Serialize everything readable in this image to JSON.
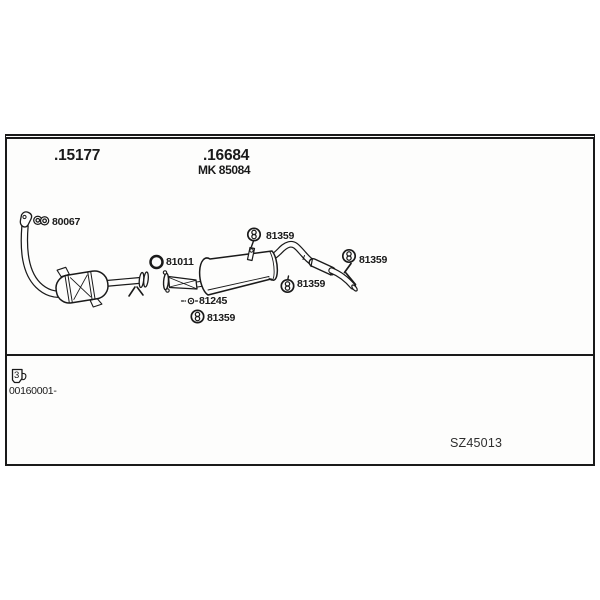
{
  "colors": {
    "ink": "#1a1a1a",
    "paper": "#ffffff"
  },
  "header": {
    "front_section_number": ".15177",
    "rear_section_number": ".16684",
    "rear_section_alt_number": "MK 85084"
  },
  "diagram": {
    "type": "exhaust-system-parts-diagram",
    "parts": {
      "front_flange_gasket": {
        "number": "80067",
        "icon": "two-hole-gasket-icon"
      },
      "pipe_ring_gasket": {
        "number": "81011",
        "icon": "ring-gasket-icon"
      },
      "hanger_top": {
        "number": "81359",
        "icon": "rubber-hanger-icon"
      },
      "hanger_middle": {
        "number": "81359",
        "icon": "rubber-hanger-icon"
      },
      "hanger_tail": {
        "number": "81359",
        "icon": "rubber-hanger-icon"
      },
      "hanger_bottom": {
        "number": "81359",
        "icon": "rubber-hanger-icon"
      },
      "mounting_bolt": {
        "number": "81245",
        "icon": "bolt-icon"
      }
    }
  },
  "footer": {
    "note_number": "3",
    "note_icon": "note-tag-icon",
    "serial_range": "00160001-",
    "drawing_code": "SZ45013"
  }
}
